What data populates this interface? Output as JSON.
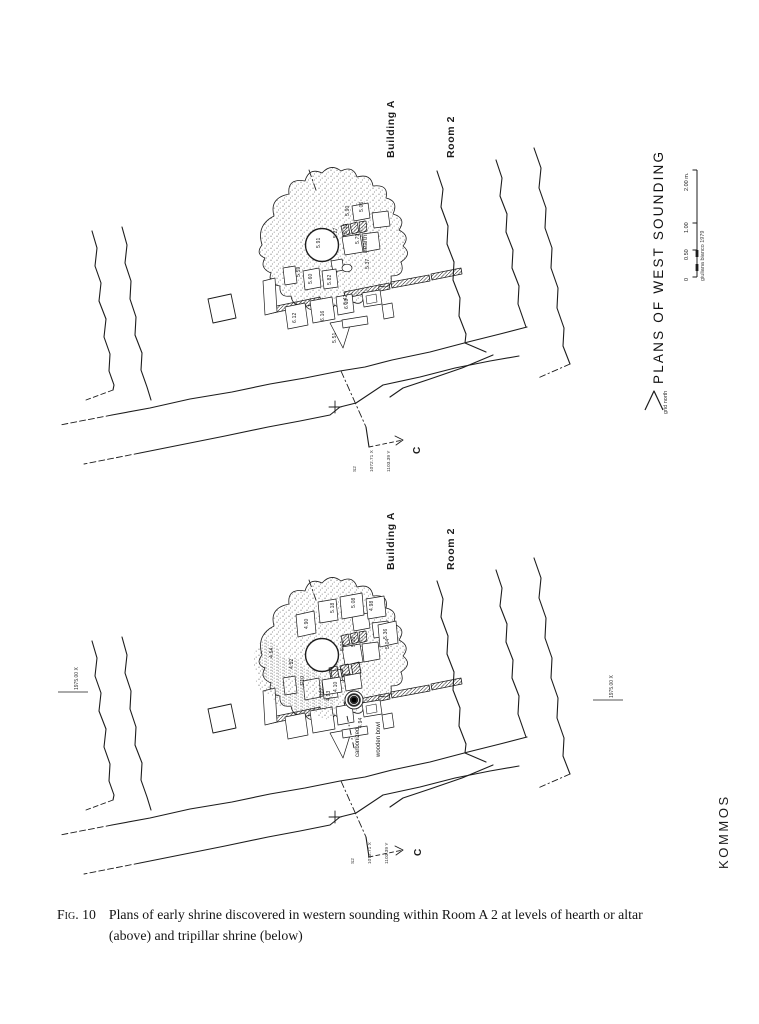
{
  "page": {
    "caption": {
      "fig_label": "Fig. 10",
      "text": "Plans of early shrine discovered in western sounding within Room A 2 at levels of hearth or altar",
      "text_line2": "(above) and tripillar shrine (below)"
    }
  },
  "margin": {
    "title": "PLANS OF WEST SOUNDING",
    "north_label": "grid north",
    "scale_ticks": [
      "0",
      "0.50",
      "1.00",
      "2.00 m."
    ],
    "credit": "giuliana bianco 1979",
    "site_line1": "KOMMOS",
    "site_line2": "GREEK SANCTUARY"
  },
  "top_plan": {
    "building": "Building A",
    "room": "Room 2",
    "hearth_label": "hearth",
    "section_label": "C",
    "datum_lines": [
      "S2",
      "1072.71 X",
      "1103.39 Y"
    ],
    "spots": [
      "5.90",
      "5.06",
      "5.13",
      "5.79",
      "5.27",
      "5.91",
      "5.37",
      "5.59",
      "5.60",
      "5.82",
      "6.42",
      "6.12",
      "6.16",
      "6.19",
      "5.51"
    ]
  },
  "bottom_plan": {
    "building": "Building A",
    "room": "Room 2",
    "bowl_label_line1": "carbonized",
    "bowl_label_line2": "wooden bowl",
    "section_label": "C",
    "datum_lines": [
      "S2",
      "1072.71 X",
      "1103.39 Y"
    ],
    "grid_left": "1975.00 X",
    "grid_right": "1975.00 X",
    "spots": [
      "5.08",
      "4.98",
      "5.18",
      "4.90",
      "5.36",
      "5.01",
      "5.10",
      "4.54",
      "4.52",
      "4.93",
      "B22",
      "4.10",
      "F10",
      "4.94",
      "5.04"
    ]
  },
  "colors": {
    "ink": "#1c1c1c",
    "paper": "#ffffff"
  }
}
